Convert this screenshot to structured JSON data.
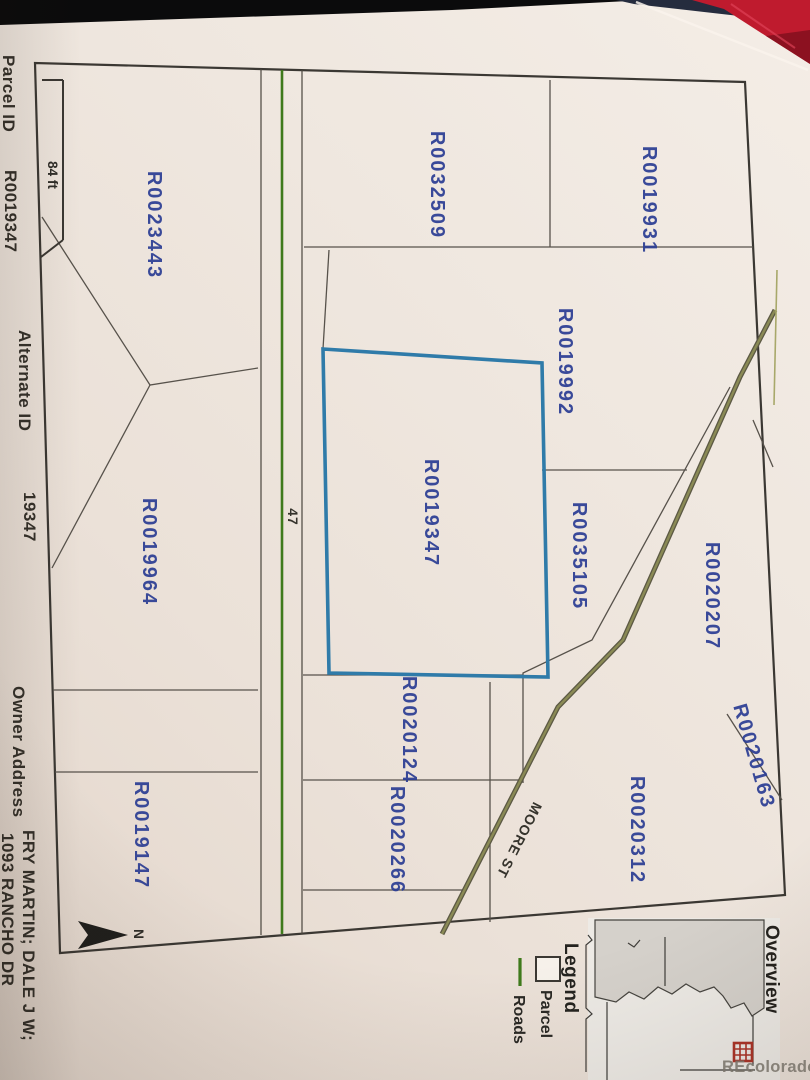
{
  "photo": {
    "watermark": "REcolorado"
  },
  "info_bar": {
    "parcel_id_label": "Parcel ID",
    "parcel_id_value": "R0019347",
    "alternate_id_label": "Alternate ID",
    "alternate_id_value": "19347",
    "owner_address_label": "Owner Address",
    "owner_address_line1": "FRY MARTIN; DALE J W;",
    "owner_address_line2": "1093 RANCHO DR"
  },
  "map": {
    "scale_bar_label": "84 ft",
    "north_arrow_label": "N",
    "road_47_label": "47",
    "moore_st_label": "MOORE ST",
    "highlighted_parcel_id": "R0019347",
    "colors": {
      "highlight_blue": "#2f7ba9",
      "road_green": "#3f7a1c",
      "moore_olive": "#7d7d4a",
      "parcel_label_blue": "#2c3e94",
      "boundary_gray": "#57524b"
    },
    "parcels": [
      {
        "label": "R0019931"
      },
      {
        "label": "R0032509"
      },
      {
        "label": "R0019992"
      },
      {
        "label": "R0035105"
      },
      {
        "label": "R0019347"
      },
      {
        "label": "R0020207"
      },
      {
        "label": "R0020163"
      },
      {
        "label": "R0020312"
      },
      {
        "label": "R0020124"
      },
      {
        "label": "R0020266"
      },
      {
        "label": "R0023443"
      },
      {
        "label": "R0019964"
      },
      {
        "label": "R0019147"
      }
    ]
  },
  "sidebar": {
    "overview_title": "Overview",
    "legend_title": "Legend",
    "legend_items": [
      {
        "symbol": "parcel-square",
        "label": "Parcel"
      },
      {
        "symbol": "roads-line",
        "label": "Roads"
      }
    ]
  }
}
